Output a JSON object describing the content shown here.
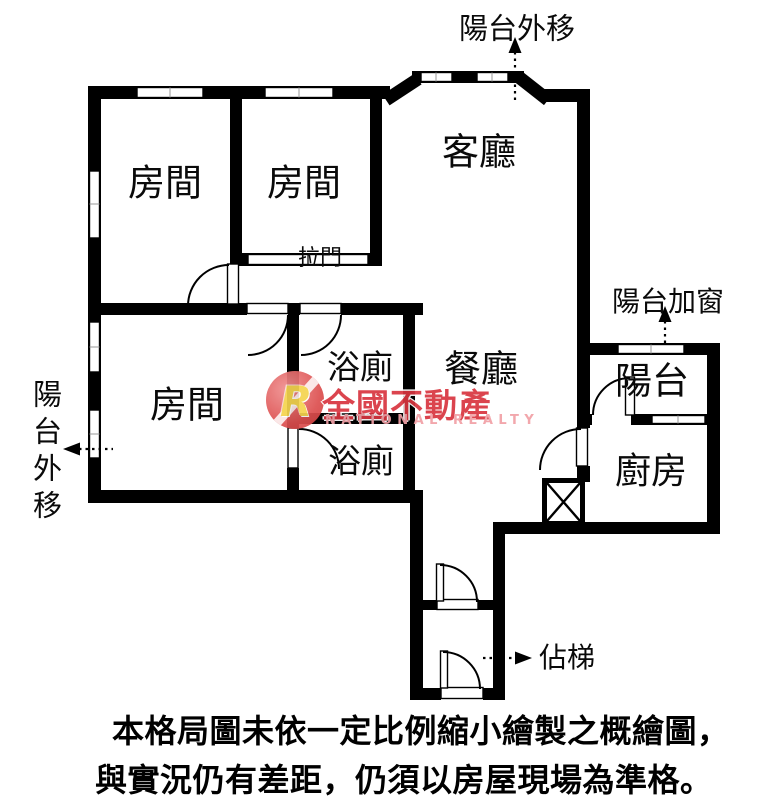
{
  "labels": {
    "balcony_out_top": "陽台外移",
    "balcony_out_left": "陽台外移",
    "balcony_add_window": "陽台加窗",
    "living_room": "客廳",
    "room_top_left": "房間",
    "room_top_mid": "房間",
    "room_bottom_left": "房間",
    "sliding_door": "拉門",
    "bath_top": "浴廁",
    "bath_bottom": "浴廁",
    "dining_room": "餐廳",
    "balcony": "陽台",
    "kitchen": "廚房",
    "stairs": "佔梯"
  },
  "watermark": {
    "logo_letter": "R",
    "brand": "全國不動產",
    "brand_en": "NATIONAL REALTY",
    "brand_color": "#d8353f",
    "brand_en_color": "#f1a0a6"
  },
  "disclaimer": {
    "line1": "本格局圖未依一定比例縮小繪製之概繪圖，",
    "line2": "與實況仍有差距，仍須以房屋現場為準格。"
  },
  "colors": {
    "wall": "#000000",
    "background": "#ffffff"
  }
}
